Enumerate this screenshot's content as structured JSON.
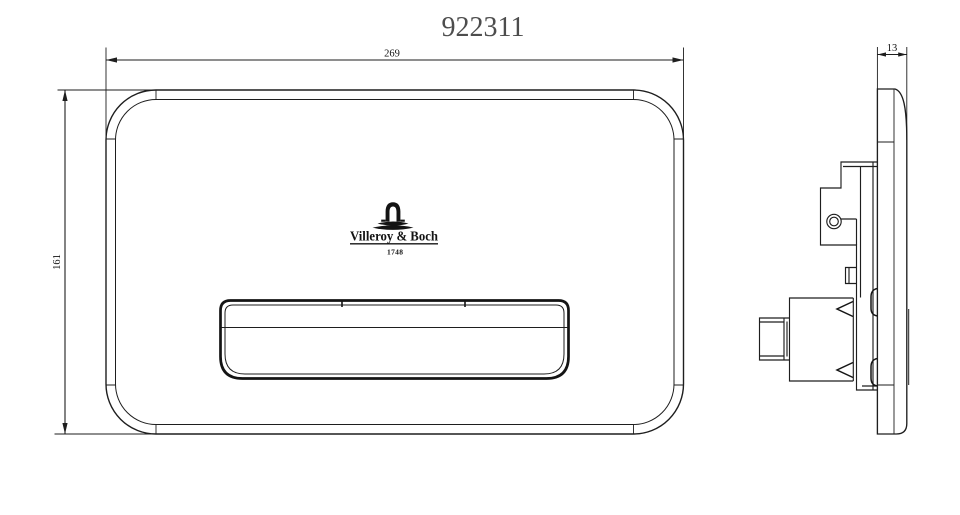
{
  "title": "922311",
  "front_view": {
    "width_dim": "269",
    "height_dim": "161",
    "logo": {
      "brand": "Villeroy & Boch",
      "year": "1748"
    }
  },
  "side_view": {
    "depth_dim": "13"
  },
  "colors": {
    "background": "#ffffff",
    "line": "#1e1e1e",
    "title_text": "#4d4d4d"
  }
}
